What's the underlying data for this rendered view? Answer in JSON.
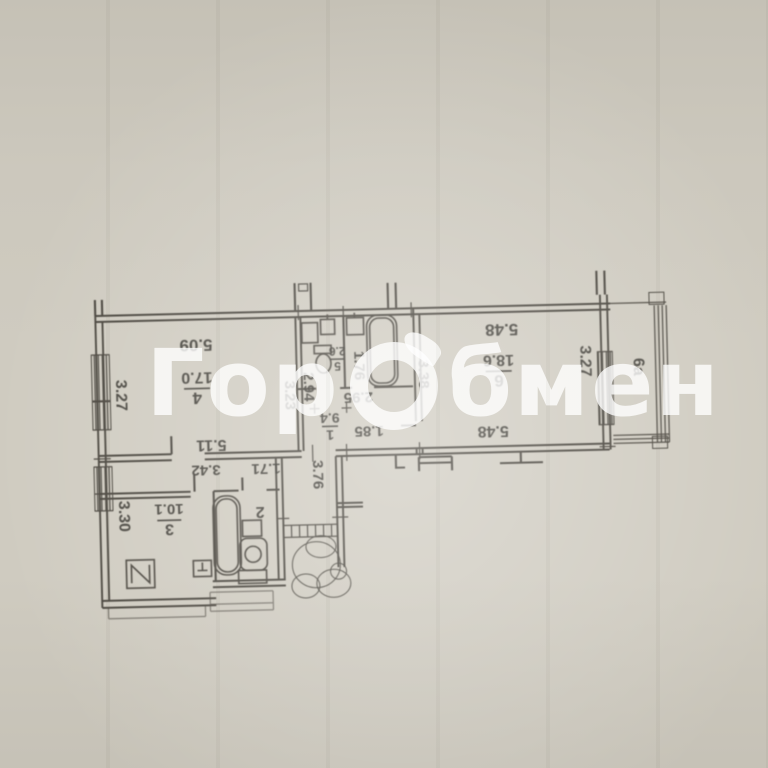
{
  "watermark": {
    "left": "Гор",
    "right": "бмен"
  },
  "plan": {
    "rooms": {
      "r4": {
        "num": "4",
        "area": "17.0"
      },
      "r5": {
        "num": "5",
        "area": "2.6"
      },
      "r1": {
        "num": "1",
        "area": "9.4"
      },
      "r6": {
        "num": "6",
        "area": "18.6"
      },
      "r3": {
        "num": "3",
        "area": "10.1"
      },
      "r2": {
        "num": "2"
      },
      "balcony": {
        "label": "6а"
      }
    },
    "dims": {
      "d509": "5.09",
      "d511": "5.11",
      "d327l": "3.27",
      "d323": "3.23",
      "d294": "2.94",
      "d176": "1.76",
      "d295": "2.95",
      "d185": "1.85",
      "d338": "3.38",
      "d548t": "5.48",
      "d548b": "5.48",
      "d327r": "3.27",
      "d342": "3.42",
      "d171": "1.71",
      "d376": "3.76",
      "d330": "3.30"
    }
  }
}
